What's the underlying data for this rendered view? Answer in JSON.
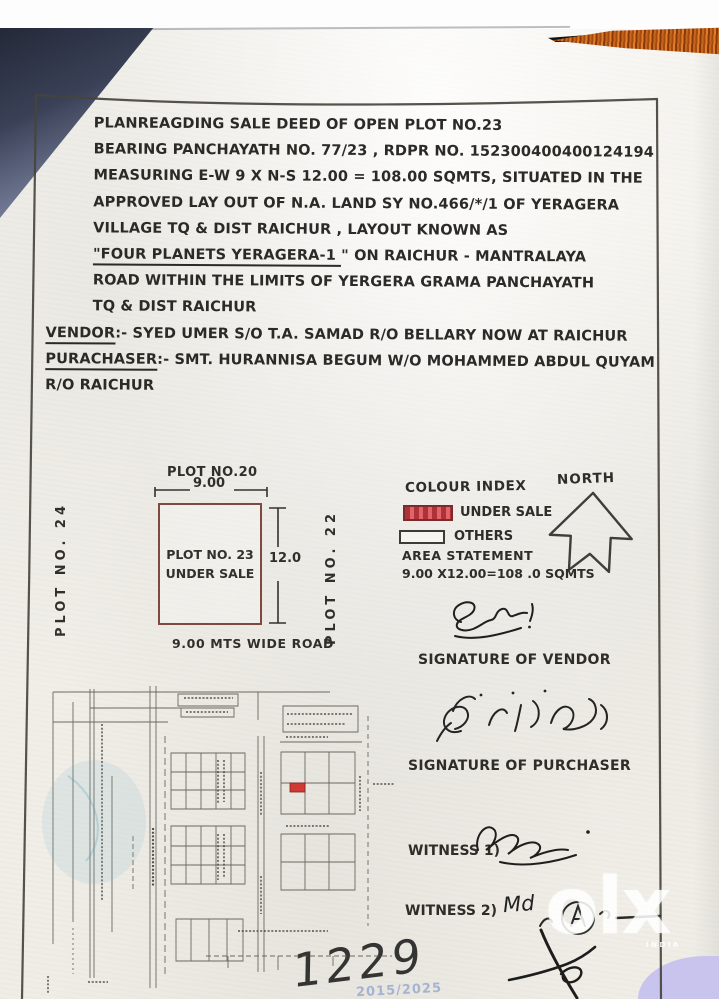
{
  "doc": {
    "lines1": [
      "PLANREAGDING SALE DEED OF  OPEN PLOT NO.23",
      "BEARING PANCHAYATH NO. 77/23 , RDPR NO. 152300400400124194",
      "MEASURING E-W 9 X N-S 12.00 = 108.00 SQMTS, SITUATED IN THE",
      "APPROVED LAY OUT OF N.A. LAND SY NO.466/*/1 OF YERAGERA",
      "VILLAGE TQ  & DIST  RAICHUR , LAYOUT KNOWN AS"
    ],
    "title_quoted": "\"FOUR PLANETS YERAGERA-1 ",
    "title_rest": "\" ON RAICHUR - MANTRALAYA",
    "lines2": [
      "ROAD WITHIN THE LIMITS OF  YERGERA GRAMA PANCHAYATH",
      "TQ & DIST RAICHUR"
    ],
    "vendor_label": "VENDOR",
    "vendor_rest": ":- SYED UMER S/O T.A. SAMAD R/O BELLARY NOW AT RAICHUR",
    "purchaser_label": "PURACHASER",
    "purchaser_rest": ":- SMT. HURANNISA BEGUM W/O MOHAMMED ABDUL QUYAM",
    "purchaser_line2": "R/O  RAICHUR"
  },
  "diagram": {
    "plot_top": "PLOT NO.20",
    "dim_top": "9.00",
    "plot_center_1": "PLOT NO. 23",
    "plot_center_2": "UNDER SALE",
    "dim_right": "12.0",
    "plot_left": "PLOT NO. 24",
    "plot_right": "PLOT NO. 22",
    "road_label": "9.00 MTS WIDE ROAD",
    "under_sale_border_color": "#7d4a42"
  },
  "legend": {
    "title": "COLOUR INDEX",
    "north_label": "NORTH",
    "items": [
      {
        "label": "UNDER SALE",
        "color": "#e2646a"
      },
      {
        "label": "OTHERS",
        "color": "#ffffff"
      }
    ],
    "area_title": "AREA STATEMENT",
    "area_value": "9.00 X12.00=108 .0 SQMTS"
  },
  "signatures": {
    "vendor_caption": "SIGNATURE OF VENDOR",
    "purchaser_caption": "SIGNATURE OF PURCHASER",
    "witness1_label": "WITNESS 1)",
    "witness2_label": "WITNESS 2)",
    "witness2_hand": "Md",
    "page_number": "1229",
    "faint_stamp": "2015/2025"
  },
  "watermark": {
    "brand": "olx",
    "country": "INDIA"
  }
}
